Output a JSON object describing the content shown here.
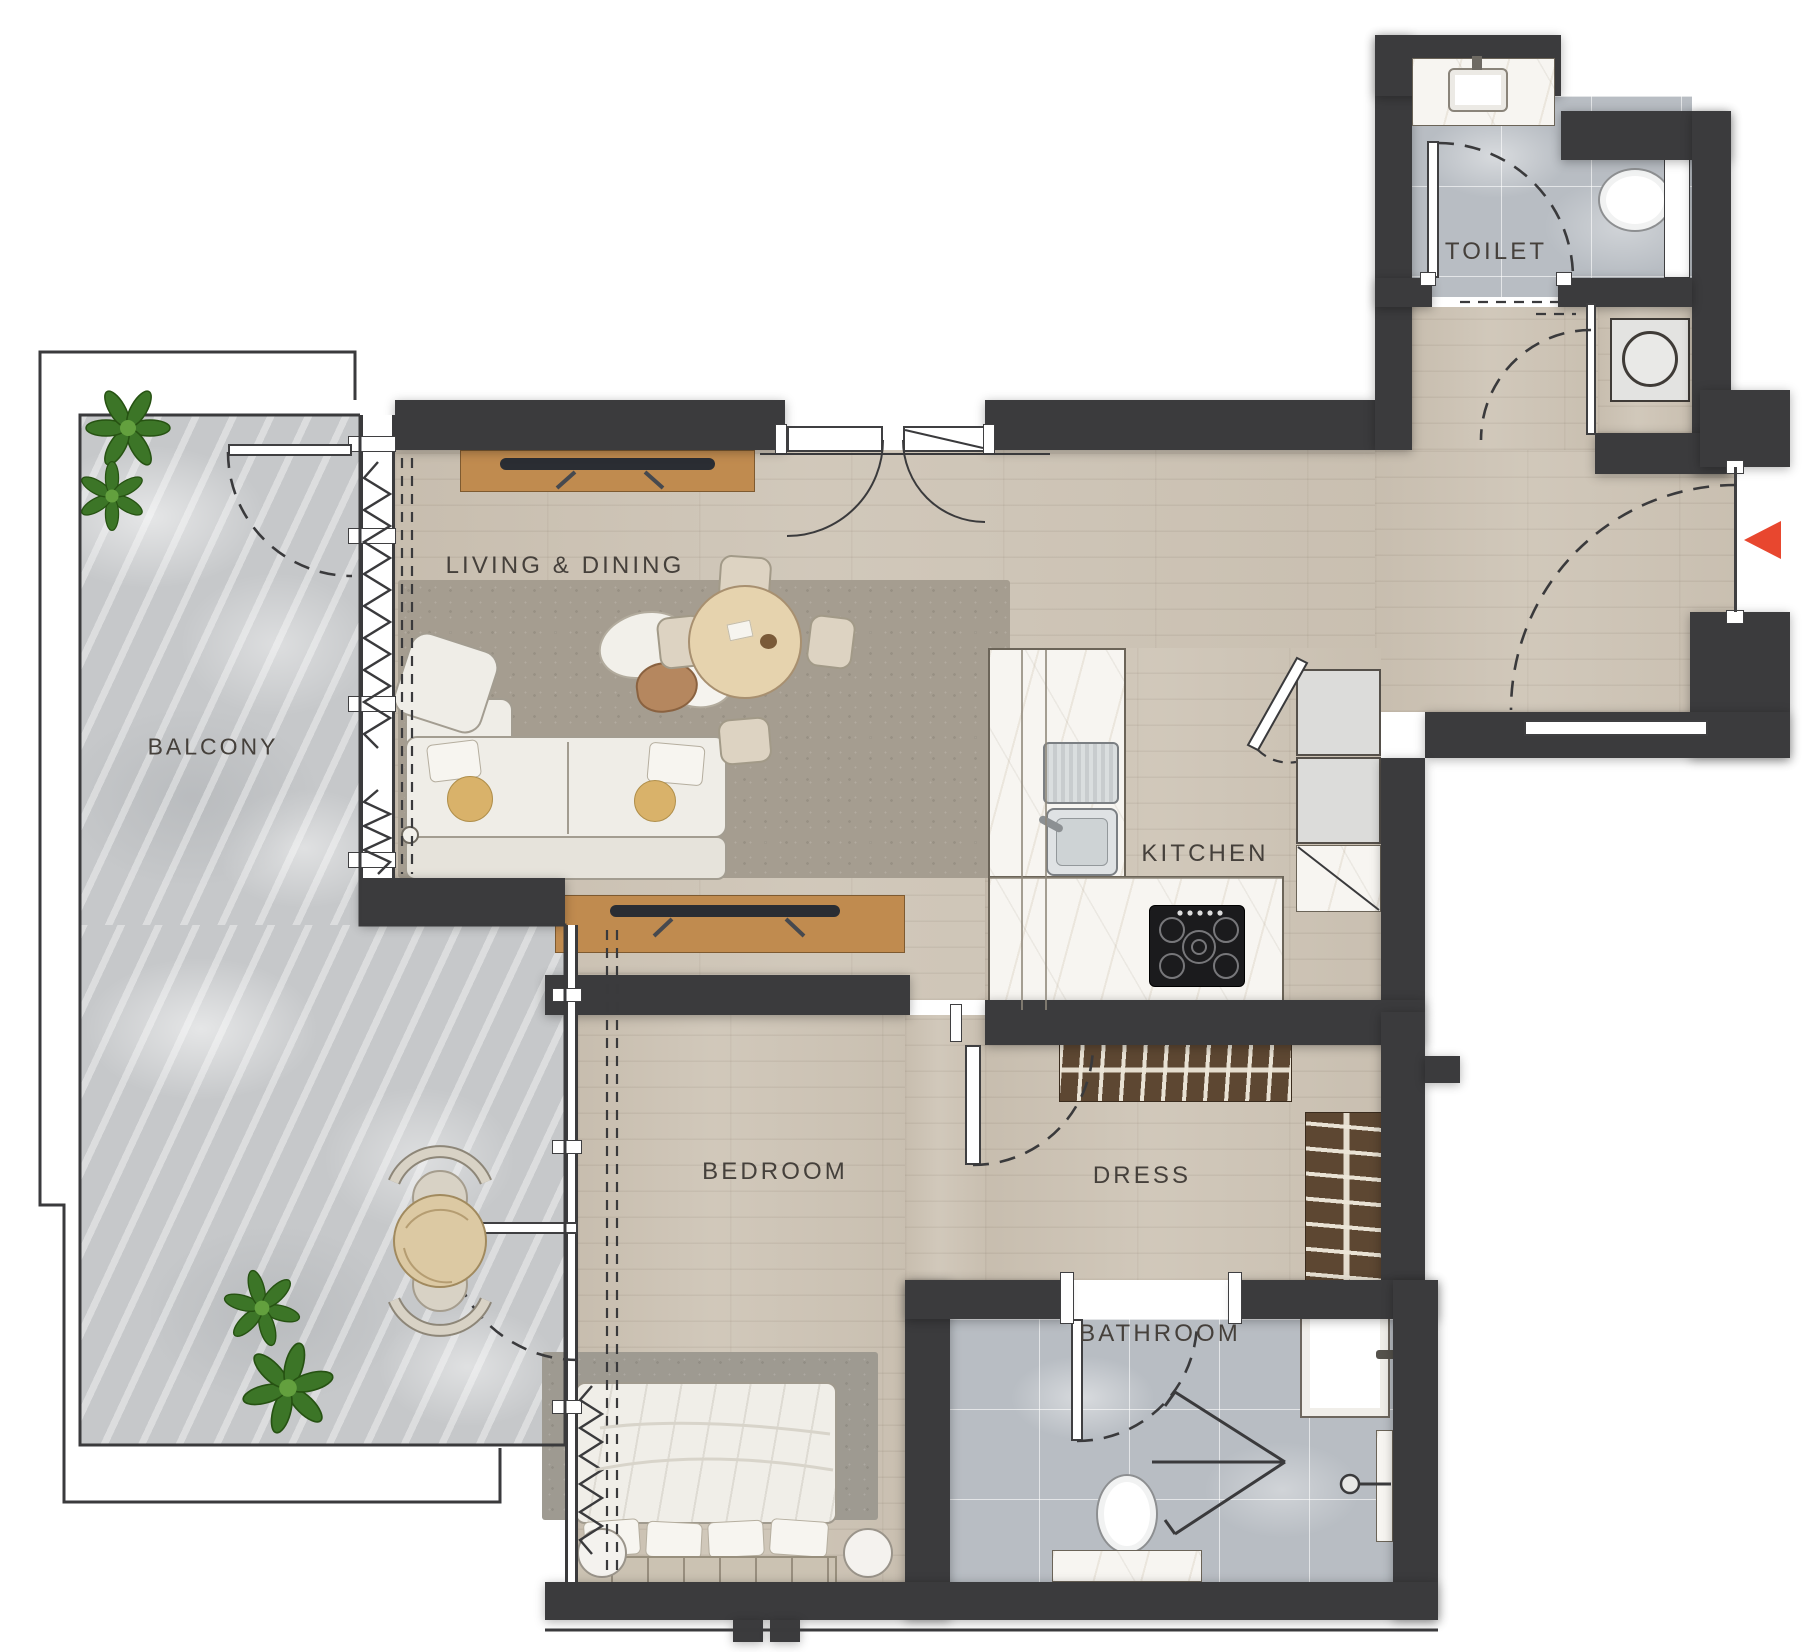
{
  "plan": {
    "rooms": [
      {
        "id": "living",
        "label": "LIVING & DINING",
        "furniture": [
          "tv-console",
          "sofa",
          "coffee-tables",
          "armchair",
          "dining-table",
          "rug"
        ]
      },
      {
        "id": "balcony",
        "label": "BALCONY",
        "furniture": [
          "plants",
          "bistro-table",
          "outdoor-chairs"
        ]
      },
      {
        "id": "kitchen",
        "label": "KITCHEN",
        "furniture": [
          "sink",
          "counter",
          "gas-stove",
          "refrigerator"
        ]
      },
      {
        "id": "toilet",
        "label": "TOILET",
        "furniture": [
          "wash-basin",
          "toilet",
          "washing-machine"
        ]
      },
      {
        "id": "bedroom",
        "label": "BEDROOM",
        "furniture": [
          "double-bed",
          "side-tables",
          "tv-console",
          "rug"
        ]
      },
      {
        "id": "dress",
        "label": "DRESS",
        "furniture": [
          "wardrobe-top",
          "wardrobe-side"
        ]
      },
      {
        "id": "bathroom",
        "label": "BATHROOM",
        "furniture": [
          "vanity-sink",
          "toilet",
          "shower"
        ]
      }
    ],
    "entrance": {
      "marker": "red-arrow",
      "direction": "left",
      "color": "#e8472f"
    },
    "colors": {
      "wall": "#3b3b3d",
      "wood_floor": "#cdc4b6",
      "balcony_stone": "#c6c8ca",
      "bath_tile": "#b8bdc3",
      "counter_marble": "#f7f5f1",
      "wardrobe": "#5d4732"
    }
  }
}
